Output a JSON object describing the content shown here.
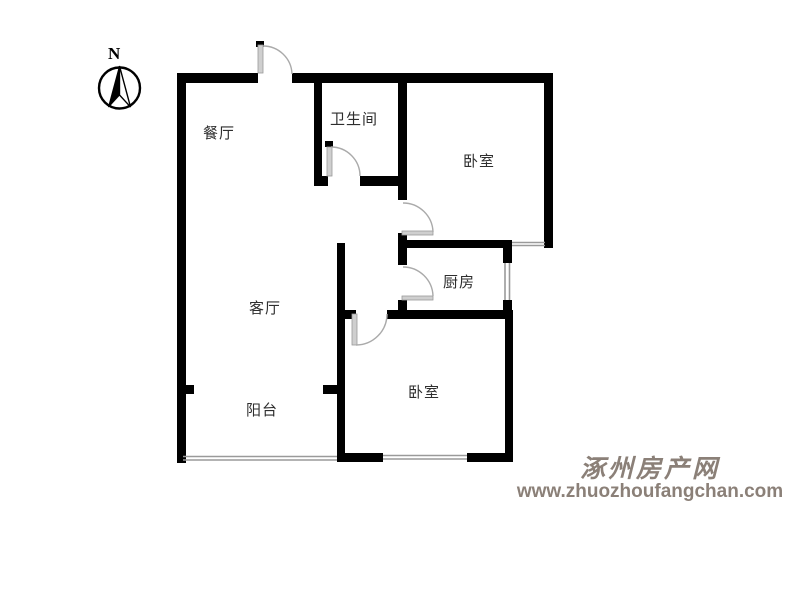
{
  "compass": {
    "label": "N"
  },
  "rooms": [
    {
      "id": "dining",
      "label": "餐厅"
    },
    {
      "id": "bathroom",
      "label": "卫生间"
    },
    {
      "id": "bedroom-top",
      "label": "卧室"
    },
    {
      "id": "kitchen",
      "label": "厨房"
    },
    {
      "id": "living",
      "label": "客厅"
    },
    {
      "id": "balcony",
      "label": "阳台"
    },
    {
      "id": "bedroom-bottom",
      "label": "卧室"
    }
  ],
  "watermark": {
    "site_name": "涿州房产网",
    "site_url": "www.zhuozhoufangchan.com"
  },
  "colors": {
    "wall": "#000000",
    "door": "#cfcfcf",
    "arc": "#aaaaaa",
    "window": "#9a9a9a",
    "label": "#2e2e2e",
    "watermark": "#8b8078"
  }
}
